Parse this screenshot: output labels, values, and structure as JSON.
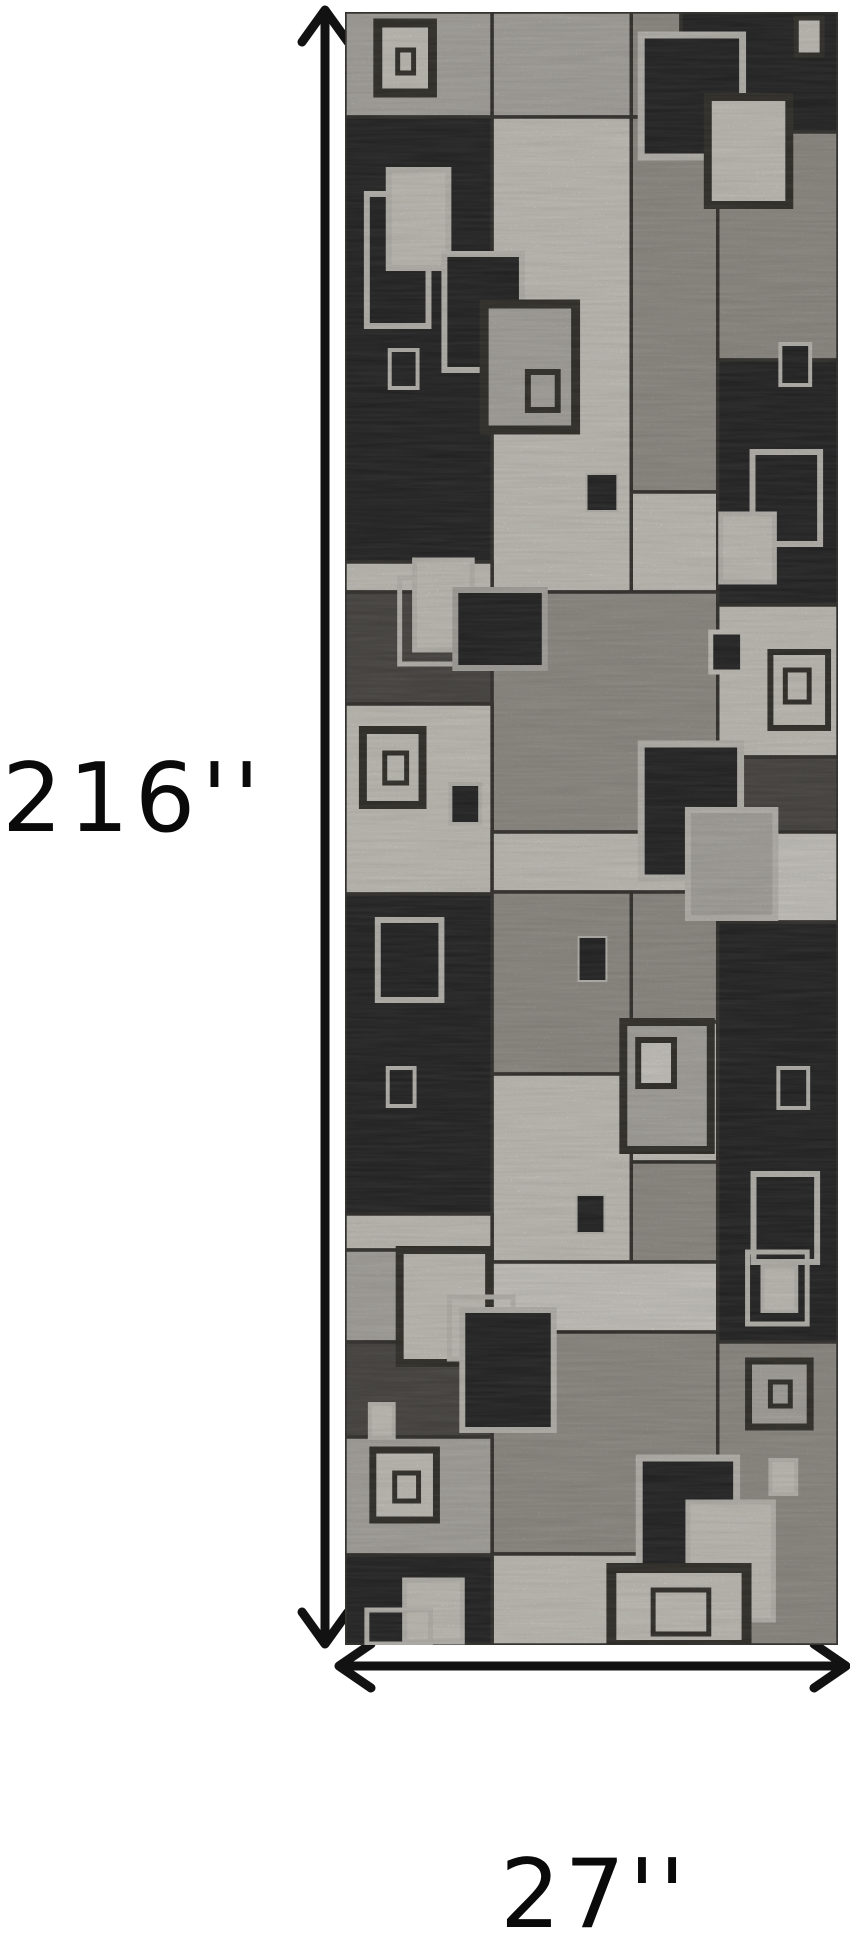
{
  "scene": {
    "description": "Product dimensions illustration of a gray and black modern geometric runner rug with overlapping squares pattern",
    "background": "#ffffff"
  },
  "dimensions": {
    "height_label": "216''",
    "width_label": "27''",
    "text_color": "#0a0a0a",
    "arrow_color": "#121212"
  },
  "rug": {
    "left": 345,
    "top": 12,
    "width": 496,
    "height": 1633,
    "base_color": "#aba79f",
    "seam_color": "#3c3a35",
    "palette": {
      "K": "#2b2b2b",
      "D": "#56534e",
      "G": "#aba79f",
      "L": "#c7c4bd",
      "W": "#e8e5dc",
      "W2": "#f0ede5",
      "FL": "#dcd9d1",
      "FD": "#3a3831"
    },
    "blocks": [
      [
        0,
        0,
        148,
        105,
        "L"
      ],
      [
        148,
        0,
        140,
        105,
        "L"
      ],
      [
        288,
        0,
        50,
        105,
        "G"
      ],
      [
        338,
        0,
        158,
        120,
        "K"
      ],
      [
        0,
        105,
        148,
        445,
        "K"
      ],
      [
        148,
        105,
        140,
        475,
        "W"
      ],
      [
        288,
        105,
        87,
        375,
        "G"
      ],
      [
        375,
        120,
        121,
        228,
        "G"
      ],
      [
        375,
        348,
        121,
        245,
        "K"
      ],
      [
        288,
        480,
        87,
        100,
        "W"
      ],
      [
        0,
        550,
        148,
        30,
        "W"
      ],
      [
        0,
        580,
        148,
        112,
        "D"
      ],
      [
        148,
        580,
        227,
        240,
        "G"
      ],
      [
        375,
        593,
        121,
        152,
        "W"
      ],
      [
        0,
        692,
        148,
        190,
        "W"
      ],
      [
        375,
        745,
        121,
        75,
        "D"
      ],
      [
        148,
        820,
        227,
        60,
        "W"
      ],
      [
        375,
        820,
        121,
        90,
        "W2"
      ],
      [
        0,
        882,
        148,
        320,
        "K"
      ],
      [
        148,
        880,
        140,
        182,
        "G"
      ],
      [
        288,
        880,
        87,
        130,
        "G"
      ],
      [
        288,
        1010,
        87,
        140,
        "W"
      ],
      [
        288,
        1150,
        87,
        100,
        "G"
      ],
      [
        148,
        1062,
        140,
        188,
        "W"
      ],
      [
        375,
        910,
        121,
        420,
        "K"
      ],
      [
        0,
        1202,
        148,
        36,
        "W"
      ],
      [
        0,
        1238,
        148,
        92,
        "L"
      ],
      [
        0,
        1330,
        148,
        95,
        "D"
      ],
      [
        148,
        1250,
        227,
        70,
        "W2"
      ],
      [
        148,
        1320,
        227,
        222,
        "G"
      ],
      [
        0,
        1425,
        148,
        118,
        "L"
      ],
      [
        148,
        1542,
        227,
        91,
        "W"
      ],
      [
        375,
        1330,
        121,
        303,
        "G"
      ],
      [
        0,
        1543,
        148,
        90,
        "K"
      ]
    ],
    "motifs": [
      [
        33,
        11,
        55,
        70,
        "FD",
        "W",
        9
      ],
      [
        53,
        38,
        16,
        23,
        "FD",
        "W",
        5
      ],
      [
        454,
        6,
        26,
        37,
        "FD",
        "W",
        5
      ],
      [
        298,
        23,
        102,
        122,
        "FL",
        "K",
        7
      ],
      [
        365,
        85,
        82,
        108,
        "FD",
        "W",
        8
      ],
      [
        22,
        182,
        62,
        132,
        "FL",
        null,
        6
      ],
      [
        44,
        158,
        60,
        98,
        "FL",
        "W",
        6
      ],
      [
        100,
        242,
        78,
        116,
        "FL",
        "K",
        6
      ],
      [
        45,
        338,
        28,
        38,
        "FL",
        "K",
        4
      ],
      [
        140,
        292,
        92,
        126,
        "FD",
        "L",
        9
      ],
      [
        184,
        360,
        30,
        38,
        "FD",
        "L",
        6
      ],
      [
        438,
        332,
        30,
        41,
        "FL",
        "K",
        4
      ],
      [
        243,
        462,
        31,
        37,
        "FL",
        "K",
        2
      ],
      [
        410,
        440,
        68,
        92,
        "FL",
        "K",
        6
      ],
      [
        378,
        502,
        54,
        68,
        "FL",
        "W",
        5
      ],
      [
        55,
        566,
        62,
        86,
        "FL",
        null,
        5
      ],
      [
        70,
        548,
        58,
        90,
        "FL",
        "W",
        5
      ],
      [
        111,
        578,
        90,
        78,
        "L",
        "K",
        6
      ],
      [
        18,
        718,
        60,
        75,
        "FD",
        "W",
        8
      ],
      [
        40,
        741,
        22,
        30,
        "FD",
        "W",
        5
      ],
      [
        106,
        772,
        30,
        40,
        "FL",
        "K",
        4
      ],
      [
        368,
        620,
        32,
        40,
        "W",
        "K",
        5
      ],
      [
        428,
        640,
        58,
        76,
        "FD",
        "W",
        6
      ],
      [
        443,
        658,
        24,
        32,
        "FD",
        "W",
        5
      ],
      [
        298,
        732,
        100,
        134,
        "FL",
        "K",
        7
      ],
      [
        345,
        798,
        88,
        108,
        "FL",
        "L",
        6
      ],
      [
        33,
        908,
        64,
        80,
        "FL",
        "K",
        6
      ],
      [
        43,
        1056,
        27,
        38,
        "FL",
        "K",
        4
      ],
      [
        235,
        925,
        28,
        44,
        "FL",
        "K",
        2
      ],
      [
        233,
        1183,
        28,
        38,
        "FL",
        "K",
        2
      ],
      [
        280,
        1010,
        88,
        128,
        "FD",
        "L",
        8
      ],
      [
        295,
        1028,
        36,
        46,
        "FD",
        "W2",
        6
      ],
      [
        436,
        1056,
        30,
        40,
        "FL",
        "K",
        4
      ],
      [
        411,
        1162,
        64,
        88,
        "FL",
        "K",
        6
      ],
      [
        405,
        1240,
        60,
        72,
        "FL",
        null,
        5
      ],
      [
        420,
        1255,
        34,
        44,
        "FL",
        "W",
        4
      ],
      [
        55,
        1238,
        90,
        113,
        "FD",
        "W",
        8
      ],
      [
        105,
        1285,
        64,
        62,
        "FL",
        null,
        5
      ],
      [
        118,
        1298,
        92,
        120,
        "FL",
        "K",
        6
      ],
      [
        25,
        1392,
        24,
        34,
        "FL",
        "W",
        4
      ],
      [
        28,
        1438,
        64,
        70,
        "FD",
        "W",
        7
      ],
      [
        50,
        1461,
        24,
        28,
        "FD",
        "W",
        5
      ],
      [
        406,
        1349,
        62,
        66,
        "FD",
        "L",
        7
      ],
      [
        428,
        1370,
        20,
        24,
        "FD",
        "L",
        5
      ],
      [
        428,
        1448,
        26,
        34,
        "FL",
        "W",
        4
      ],
      [
        296,
        1446,
        98,
        126,
        "FL",
        "K",
        7
      ],
      [
        345,
        1490,
        86,
        118,
        "FL",
        "W",
        5
      ],
      [
        60,
        1568,
        58,
        62,
        "FL",
        "W",
        5
      ],
      [
        22,
        1598,
        64,
        34,
        "FL",
        null,
        5
      ],
      [
        268,
        1556,
        136,
        77,
        "FD",
        "W",
        10
      ],
      [
        310,
        1578,
        56,
        44,
        "FD",
        null,
        5
      ]
    ]
  }
}
